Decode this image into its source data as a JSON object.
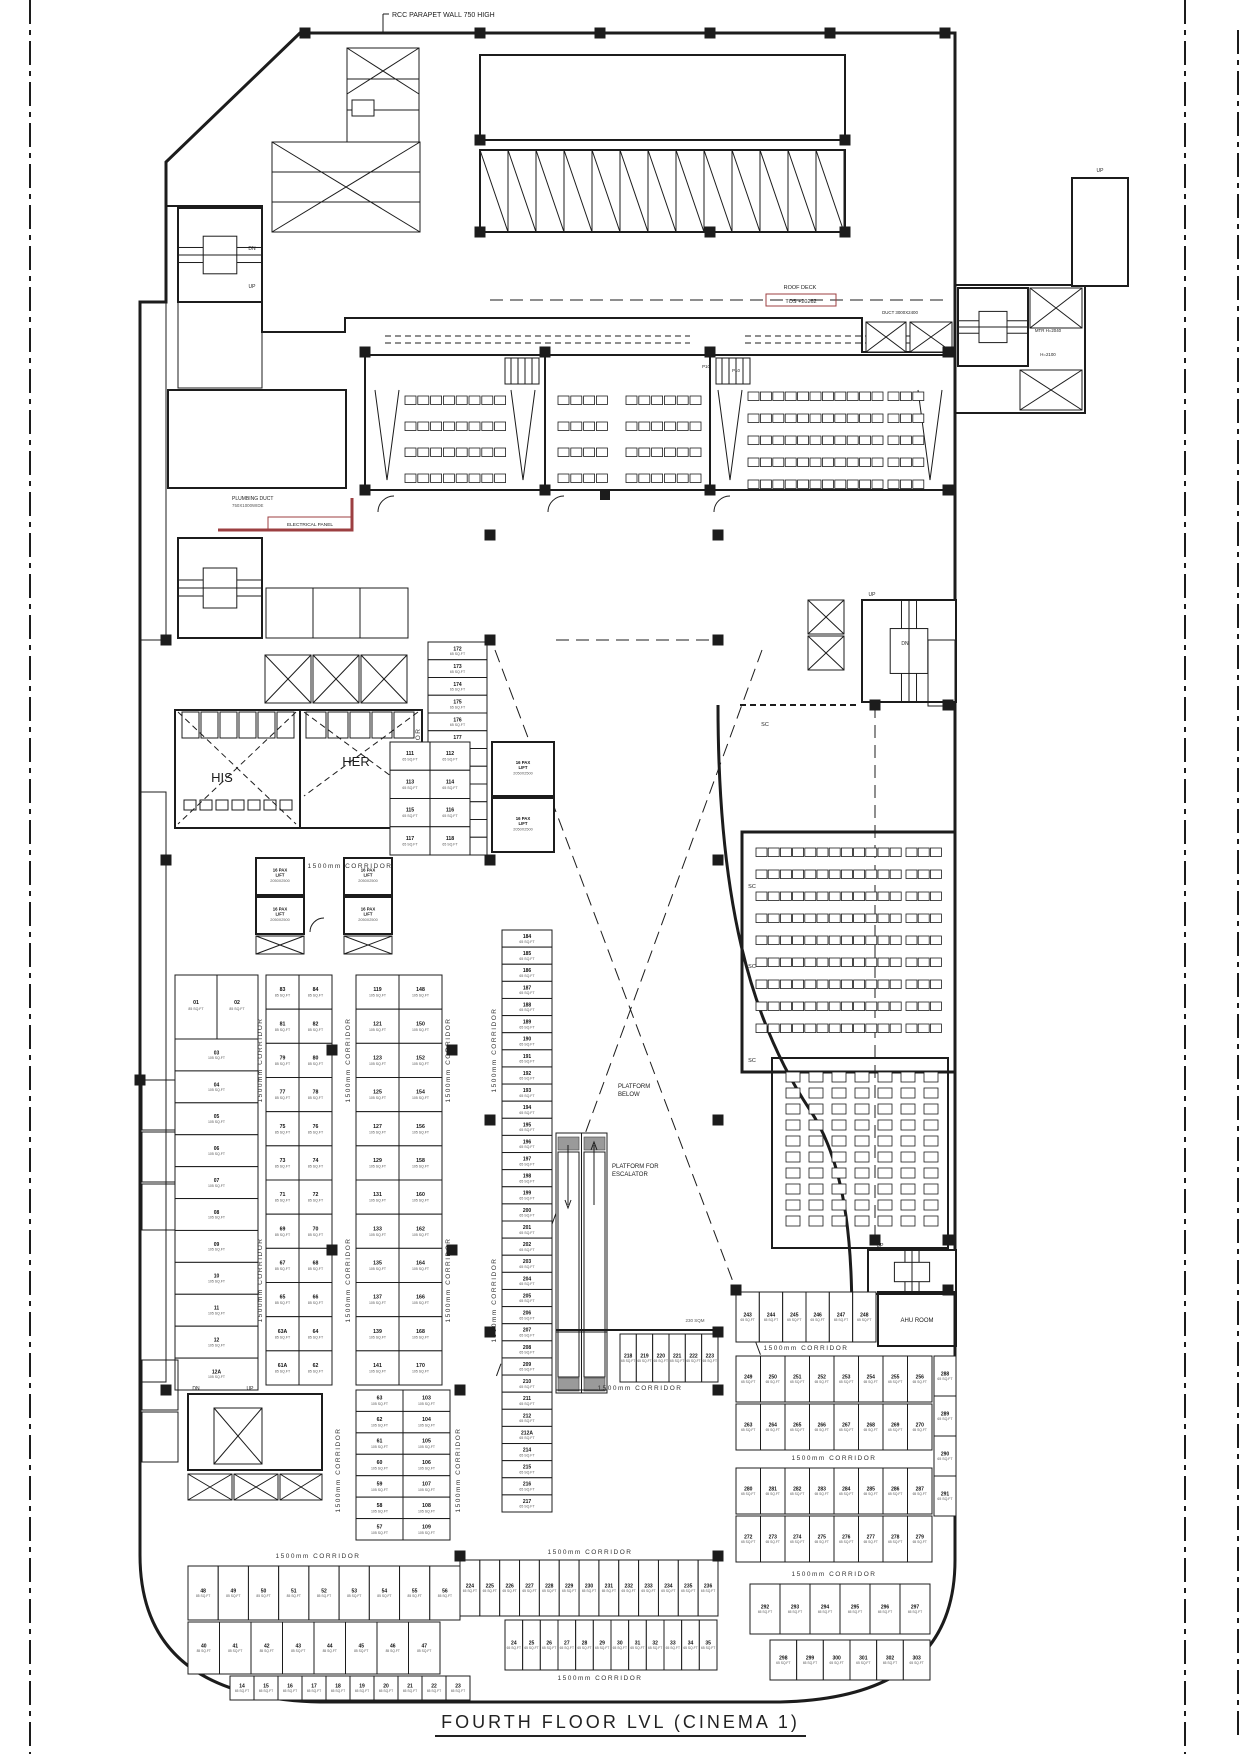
{
  "sheet": {
    "title": "FOURTH FLOOR LVL (CINEMA 1)"
  },
  "labels": {
    "parapet": "RCC PARAPET WALL 750 HIGH",
    "roof_deck": "ROOF DECK",
    "roof_tos": "TOS +20262",
    "corridor": "1500mm CORRIDOR",
    "her": "HER",
    "his": "HIS",
    "platform_below_1": "PLATFORM",
    "platform_below_2": "BELOW",
    "platform_esc_1": "PLATFORM FOR",
    "platform_esc_2": "ESCALATOR",
    "ahu": "AHU ROOM",
    "up": "UP",
    "dn": "DN",
    "sc": "SC",
    "p10": "P10",
    "duct": "DUCT 3000X2400",
    "mtr": "MTR H=2040",
    "h2100": "H=2100",
    "plumbing1": "PLUMBING DUCT",
    "plumbing2": "750X1000WIDE",
    "electrical": "ELECTRICAL PANEL",
    "sqm": "230 SQM",
    "pax1": "16 PAX",
    "pax2": "LIFT",
    "pax3": "2050X2500"
  },
  "unit_sizes": {
    "small": "65 SQ.FT",
    "medium": "85 SQ.FT",
    "large": "105 SQ.FT"
  },
  "units": {
    "strip_d_upper": [
      "172",
      "173",
      "174",
      "175",
      "176",
      "177",
      "178",
      "179",
      "180",
      "181",
      "182",
      "183"
    ],
    "strip_d_lower": [
      "184",
      "185",
      "186",
      "187",
      "188",
      "189",
      "190",
      "191",
      "192",
      "193",
      "194",
      "195",
      "196",
      "197",
      "198",
      "199",
      "200",
      "201",
      "202",
      "203",
      "204",
      "205",
      "206",
      "207",
      "208",
      "209",
      "210",
      "211",
      "212",
      "212A",
      "214",
      "215",
      "216",
      "217"
    ],
    "col_a_pair": [
      "01",
      "02"
    ],
    "col_a": [
      "03",
      "04",
      "05",
      "06",
      "07",
      "08",
      "09",
      "10",
      "11",
      "12",
      "12A"
    ],
    "grid_b_left": [
      "83",
      "81",
      "79",
      "77",
      "75",
      "73",
      "71",
      "69",
      "67",
      "65",
      "63A",
      "61A"
    ],
    "grid_b_right": [
      "84",
      "82",
      "80",
      "78",
      "76",
      "74",
      "72",
      "70",
      "68",
      "66",
      "64",
      "62"
    ],
    "grid_c_left": [
      "119",
      "121",
      "123",
      "125",
      "127",
      "129",
      "131",
      "133",
      "135",
      "137",
      "139",
      "141"
    ],
    "grid_c_right": [
      "148",
      "150",
      "152",
      "154",
      "156",
      "158",
      "160",
      "162",
      "164",
      "166",
      "168",
      "170"
    ],
    "upper_right_left": [
      "111",
      "113",
      "115",
      "117"
    ],
    "upper_right_right": [
      "112",
      "114",
      "116",
      "118"
    ],
    "mid_pairs_left": [
      "63",
      "62",
      "61",
      "60",
      "59",
      "58",
      "57"
    ],
    "mid_pairs_right": [
      "103",
      "104",
      "105",
      "106",
      "107",
      "108",
      "109"
    ],
    "row_218": [
      "218",
      "219",
      "220",
      "221",
      "222",
      "223"
    ],
    "bottom_center_a": [
      "224",
      "225",
      "226",
      "227",
      "228",
      "229",
      "230",
      "231",
      "232",
      "233",
      "234",
      "235",
      "236"
    ],
    "bottom_center_b": [
      "24",
      "25",
      "26",
      "27",
      "28",
      "29",
      "30",
      "31",
      "32",
      "33",
      "34",
      "35"
    ],
    "bottom_left_row1": [
      "48",
      "49",
      "50",
      "51",
      "52",
      "53",
      "54",
      "55",
      "56"
    ],
    "bottom_left_row2": [
      "40",
      "41",
      "42",
      "43",
      "44",
      "45",
      "46",
      "47"
    ],
    "bottom_left_tiny": [
      "14",
      "15",
      "16",
      "17",
      "18",
      "19",
      "20",
      "21",
      "22",
      "23"
    ],
    "br_corridor_row": [
      "243",
      "244",
      "245",
      "246",
      "247",
      "248"
    ],
    "br_row1": [
      "249",
      "250",
      "251",
      "252",
      "253",
      "254",
      "255",
      "256"
    ],
    "br_row2": [
      "263",
      "264",
      "265",
      "266",
      "267",
      "268",
      "269",
      "270"
    ],
    "br_row3": [
      "280",
      "281",
      "282",
      "283",
      "284",
      "285",
      "286",
      "287"
    ],
    "br_row4": [
      "272",
      "273",
      "274",
      "275",
      "276",
      "277",
      "278",
      "279"
    ],
    "br_stack": [
      "288",
      "289",
      "290",
      "291"
    ],
    "br_bottom": [
      "292",
      "293",
      "294",
      "295",
      "296",
      "297"
    ],
    "br_tiny": [
      "298",
      "299",
      "300",
      "301",
      "302",
      "303"
    ]
  },
  "halls": [
    {
      "id": "cinema-hall-1",
      "rows": 4,
      "groups": [
        8,
        0
      ]
    },
    {
      "id": "cinema-hall-2",
      "rows": 4,
      "groups": [
        4,
        6
      ]
    },
    {
      "id": "cinema-hall-3",
      "rows": 5,
      "groups": [
        11,
        3
      ]
    },
    {
      "id": "cinema-hall-right",
      "rows": 9,
      "groups": [
        12,
        3
      ]
    },
    {
      "id": "cinema-hall-lower-right",
      "cols": 7,
      "seats_per_col": 10
    }
  ],
  "colors": {
    "line": "#1c1c1c",
    "accent_red": "#9c3f41"
  }
}
